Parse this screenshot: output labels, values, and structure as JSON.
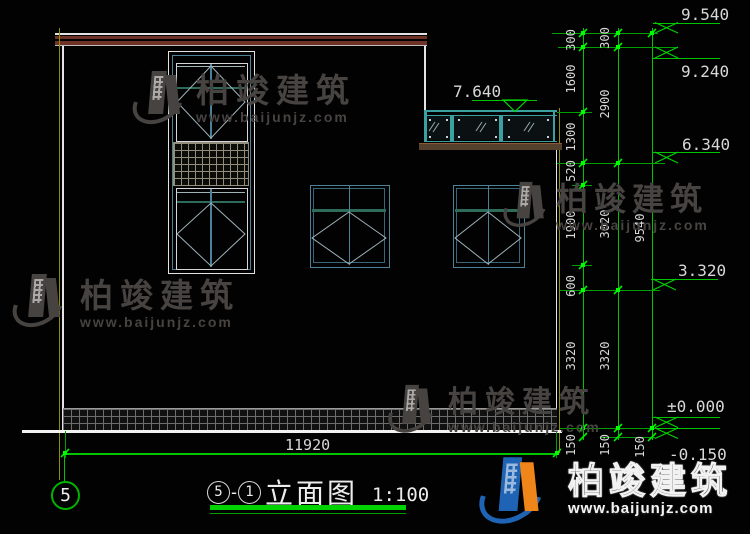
{
  "brand": {
    "name": "柏竣建筑",
    "url": "www.baijunjz.com"
  },
  "title": {
    "axis_from": "5",
    "sep": "-",
    "axis_to": "1",
    "name": "立面图",
    "scale": "1:100"
  },
  "axis_bubble": "5",
  "dims": {
    "bottom": "11920",
    "chain1": [
      "300",
      "1600",
      "1300",
      "520",
      "1900",
      "600",
      "3320",
      "150"
    ],
    "chain2": [
      "300",
      "2900",
      "3020",
      "3320",
      "150"
    ],
    "chain3": [
      "9540",
      "150"
    ]
  },
  "elevations": {
    "p9540": "9.540",
    "p9240": "9.240",
    "p7640": "7.640",
    "p6340": "6.340",
    "p3320": "3.320",
    "zero": "±0.000",
    "m150": "-0.150"
  },
  "colors": {
    "dim_green": "#00c400",
    "axis_yellow": "#8f8f06",
    "frame_teal": "#3aa0a0",
    "frame_blue": "#4d8099",
    "cap_maroon": "#6e3226",
    "sill_brown": "#55402c",
    "watermark_gray": "#474341",
    "logo_blue": "#1f64b4",
    "logo_orange": "#f08519"
  }
}
